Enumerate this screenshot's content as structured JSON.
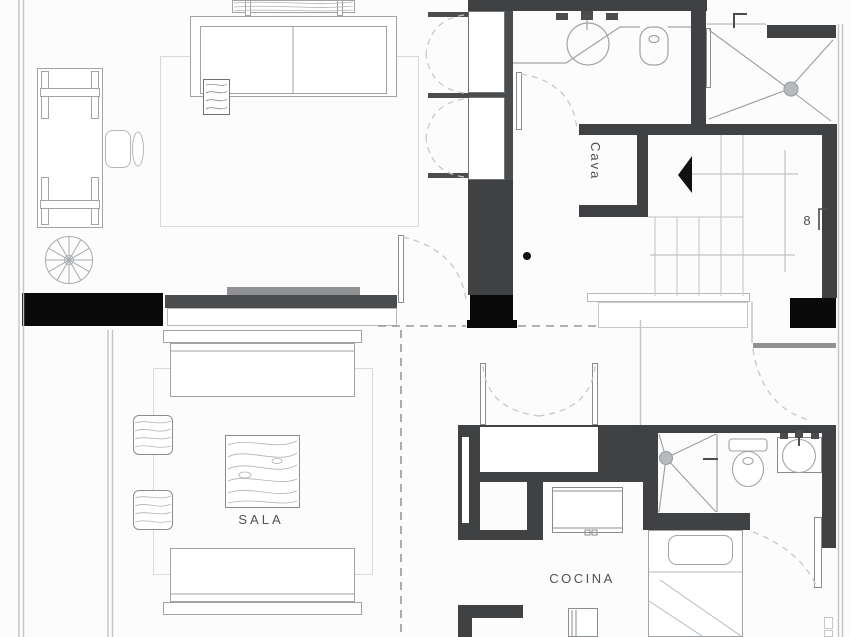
{
  "plan": {
    "type": "architectural-floor-plan",
    "labels": {
      "cava": "Cava",
      "sala": "SALA",
      "cocina": "COCINA",
      "stair_number": "8"
    },
    "rooms": [
      "Cava",
      "Sala",
      "Cocina"
    ],
    "colors": {
      "wall_dark": "#3f4142",
      "wall_black": "#0a0a0a",
      "furniture_line": "#a0a4a6",
      "light_line": "#c5c7c8",
      "dash_line": "#97999b",
      "tv_gray": "#8f9193",
      "text": "#4e5254",
      "background": "#fcfcfc"
    }
  }
}
